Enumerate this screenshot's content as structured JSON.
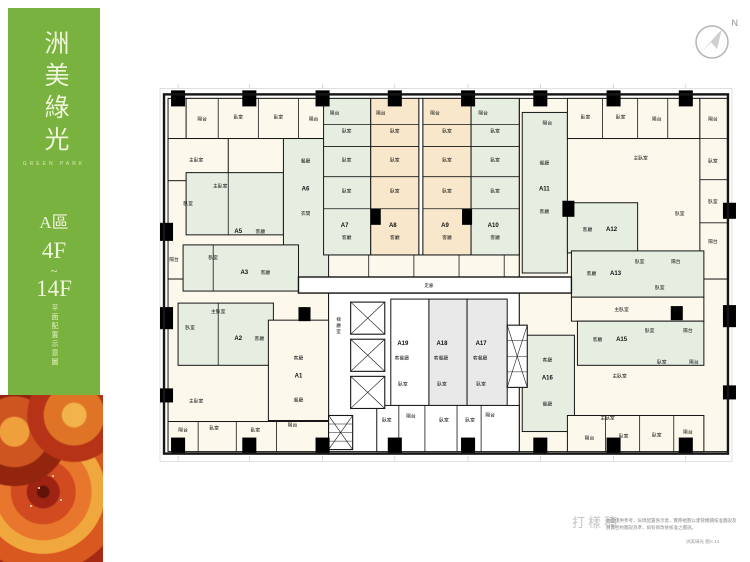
{
  "sidebar": {
    "title": "洲美綠光",
    "subtitle": "GREEN PARK",
    "zone": "A區",
    "floor_from": "4F",
    "tilde": "~",
    "floor_to": "14F",
    "caption": "平面配置示意圖",
    "bg_color": "#79b23f",
    "text_color": "#eef5da"
  },
  "compass": {
    "label": "N"
  },
  "footer": {
    "watermark": "打樣稿",
    "disclaimer1": "本圖僅供參考，傢俱配置係示意，實際規劃以建管機關核准圖說及",
    "disclaimer2": "買賣合約圖說為準，如有修改依核准之圖說。",
    "corner_note": "洲美綠光 圖A-14"
  },
  "plan": {
    "units": [
      "A1",
      "A2",
      "A3",
      "A5",
      "A6",
      "A7",
      "A8",
      "A9",
      "A10",
      "A11",
      "A12",
      "A13",
      "A15",
      "A16",
      "A17",
      "A18",
      "A19"
    ],
    "colors": {
      "wall": "#161616",
      "green": "#e6eee2",
      "peach": "#f8e7ca",
      "cream": "#fcf9ec",
      "gray": "#e9e9e9",
      "white": "#ffffff"
    },
    "rooms": [
      [
        10,
        14,
        160,
        180,
        "cream"
      ],
      [
        360,
        14,
        208,
        180,
        "cream"
      ],
      [
        10,
        194,
        160,
        172,
        "cream"
      ],
      [
        360,
        194,
        208,
        172,
        "cream"
      ],
      [
        170,
        208,
        190,
        158,
        "white"
      ],
      [
        165,
        14,
        195,
        156,
        "cream"
      ],
      [
        165,
        170,
        195,
        22,
        "cream"
      ],
      [
        28,
        14,
        142,
        40,
        "cream"
      ],
      [
        10,
        54,
        60,
        42,
        "cream"
      ],
      [
        28,
        88,
        97,
        62,
        "green"
      ],
      [
        125,
        54,
        45,
        140,
        "green"
      ],
      [
        25,
        160,
        115,
        46,
        "green"
      ],
      [
        20,
        218,
        95,
        62,
        "green"
      ],
      [
        110,
        235,
        60,
        100,
        "cream"
      ],
      [
        165,
        14,
        47,
        156,
        "green"
      ],
      [
        212,
        14,
        48,
        156,
        "peach"
      ],
      [
        260,
        14,
        4,
        156,
        "white"
      ],
      [
        264,
        14,
        48,
        156,
        "peach"
      ],
      [
        312,
        14,
        48,
        156,
        "green"
      ],
      [
        363,
        28,
        45,
        160,
        "green"
      ],
      [
        408,
        14,
        132,
        40,
        "cream"
      ],
      [
        540,
        14,
        28,
        180,
        "cream"
      ],
      [
        408,
        118,
        70,
        50,
        "green"
      ],
      [
        412,
        212,
        132,
        24,
        "cream"
      ],
      [
        412,
        166,
        132,
        46,
        "green"
      ],
      [
        418,
        236,
        126,
        44,
        "green"
      ],
      [
        363,
        250,
        52,
        96,
        "green"
      ],
      [
        232,
        214,
        38,
        106,
        "white"
      ],
      [
        270,
        214,
        38,
        106,
        "gray"
      ],
      [
        308,
        214,
        40,
        106,
        "gray"
      ],
      [
        10,
        336,
        160,
        30,
        "cream"
      ],
      [
        408,
        330,
        136,
        36,
        "cream"
      ],
      [
        218,
        320,
        142,
        46,
        "white"
      ]
    ],
    "lines": [
      [
        165,
        40,
        212,
        40
      ],
      [
        165,
        62,
        212,
        62
      ],
      [
        165,
        92,
        212,
        92
      ],
      [
        165,
        124,
        212,
        124
      ],
      [
        212,
        40,
        260,
        40
      ],
      [
        212,
        62,
        260,
        62
      ],
      [
        212,
        92,
        260,
        92
      ],
      [
        212,
        124,
        260,
        124
      ],
      [
        264,
        40,
        312,
        40
      ],
      [
        264,
        62,
        312,
        62
      ],
      [
        264,
        92,
        312,
        92
      ],
      [
        264,
        124,
        312,
        124
      ],
      [
        312,
        40,
        360,
        40
      ],
      [
        312,
        62,
        360,
        62
      ],
      [
        312,
        92,
        360,
        92
      ],
      [
        312,
        124,
        360,
        124
      ],
      [
        60,
        14,
        60,
        54
      ],
      [
        100,
        14,
        100,
        54
      ],
      [
        140,
        14,
        140,
        54
      ],
      [
        443,
        14,
        443,
        54
      ],
      [
        478,
        14,
        478,
        54
      ],
      [
        508,
        14,
        508,
        54
      ],
      [
        540,
        54,
        568,
        54
      ],
      [
        540,
        95,
        568,
        95
      ],
      [
        540,
        138,
        568,
        138
      ],
      [
        40,
        336,
        40,
        366
      ],
      [
        78,
        336,
        78,
        366
      ],
      [
        118,
        336,
        118,
        366
      ],
      [
        446,
        330,
        446,
        366
      ],
      [
        480,
        330,
        480,
        366
      ],
      [
        514,
        330,
        514,
        366
      ],
      [
        240,
        320,
        240,
        366
      ],
      [
        266,
        320,
        266,
        366
      ],
      [
        298,
        320,
        298,
        366
      ],
      [
        322,
        320,
        322,
        366
      ],
      [
        210,
        170,
        210,
        192
      ],
      [
        255,
        170,
        255,
        192
      ],
      [
        300,
        170,
        300,
        192
      ],
      [
        345,
        170,
        345,
        192
      ],
      [
        70,
        88,
        70,
        150
      ],
      [
        55,
        160,
        55,
        206
      ],
      [
        60,
        218,
        60,
        280
      ]
    ],
    "corridor": {
      "rect": [
        140,
        192,
        272,
        16
      ],
      "label": "走廊"
    },
    "elevators": [
      [
        192,
        217,
        34,
        32
      ],
      [
        192,
        254,
        34,
        32
      ],
      [
        192,
        291,
        34,
        32
      ]
    ],
    "stairs": [
      [
        348,
        240,
        20,
        62
      ],
      [
        170,
        330,
        24,
        34
      ]
    ],
    "columns": [
      [
        13,
        6,
        14,
        16
      ],
      [
        84,
        6,
        14,
        16
      ],
      [
        157,
        6,
        14,
        16
      ],
      [
        229,
        6,
        14,
        16
      ],
      [
        302,
        6,
        14,
        16
      ],
      [
        374,
        6,
        14,
        16
      ],
      [
        447,
        6,
        14,
        16
      ],
      [
        519,
        6,
        14,
        16
      ],
      [
        13,
        352,
        14,
        16
      ],
      [
        84,
        352,
        14,
        16
      ],
      [
        157,
        352,
        14,
        16
      ],
      [
        229,
        352,
        14,
        16
      ],
      [
        302,
        352,
        14,
        16
      ],
      [
        374,
        352,
        14,
        16
      ],
      [
        447,
        352,
        14,
        16
      ],
      [
        519,
        352,
        14,
        16
      ],
      [
        2,
        138,
        13,
        18
      ],
      [
        2,
        222,
        13,
        22
      ],
      [
        2,
        303,
        13,
        14
      ],
      [
        563,
        118,
        13,
        16
      ],
      [
        563,
        220,
        13,
        22
      ],
      [
        563,
        300,
        13,
        14
      ],
      [
        212,
        124,
        10,
        16
      ],
      [
        303,
        124,
        10,
        16
      ],
      [
        403,
        116,
        12,
        16
      ],
      [
        511,
        221,
        12,
        14
      ],
      [
        140,
        222,
        12,
        14
      ]
    ],
    "core_label": {
      "x": 180,
      "y": 236,
      "t": "梯廳室",
      "s": 4.5,
      "v": 1
    },
    "labels": [
      {
        "x": 44,
        "y": 36,
        "t": "陽台"
      },
      {
        "x": 80,
        "y": 34,
        "t": "臥室"
      },
      {
        "x": 120,
        "y": 34,
        "t": "臥室"
      },
      {
        "x": 155,
        "y": 36,
        "t": "陽台"
      },
      {
        "x": 38,
        "y": 77,
        "t": "主臥室"
      },
      {
        "x": 62,
        "y": 103,
        "t": "主臥室"
      },
      {
        "x": 30,
        "y": 120,
        "t": "臥室"
      },
      {
        "x": 80,
        "y": 148,
        "t": "A5",
        "s": 6,
        "b": 1
      },
      {
        "x": 102,
        "y": 148,
        "t": "客廳"
      },
      {
        "x": 147,
        "y": 78,
        "t": "餐廳"
      },
      {
        "x": 147,
        "y": 106,
        "t": "A6",
        "s": 6,
        "b": 1
      },
      {
        "x": 147,
        "y": 130,
        "t": "衣間"
      },
      {
        "x": 86,
        "y": 189,
        "t": "A3",
        "s": 6,
        "b": 1
      },
      {
        "x": 107,
        "y": 189,
        "t": "客廳"
      },
      {
        "x": 55,
        "y": 174,
        "t": "臥室"
      },
      {
        "x": 16,
        "y": 176,
        "t": "陽台"
      },
      {
        "x": 80,
        "y": 255,
        "t": "A2",
        "s": 6,
        "b": 1
      },
      {
        "x": 101,
        "y": 255,
        "t": "客廳"
      },
      {
        "x": 60,
        "y": 228,
        "t": "主臥室"
      },
      {
        "x": 32,
        "y": 244,
        "t": "臥室"
      },
      {
        "x": 140,
        "y": 274,
        "t": "客廳"
      },
      {
        "x": 140,
        "y": 292,
        "t": "A1",
        "s": 6,
        "b": 1
      },
      {
        "x": 140,
        "y": 316,
        "t": "餐廳"
      },
      {
        "x": 38,
        "y": 317,
        "t": "主臥室"
      },
      {
        "x": 25,
        "y": 346,
        "t": "陽台"
      },
      {
        "x": 56,
        "y": 344,
        "t": "臥室"
      },
      {
        "x": 97,
        "y": 346,
        "t": "臥室"
      },
      {
        "x": 134,
        "y": 341,
        "t": "陽台"
      },
      {
        "x": 176,
        "y": 30,
        "t": "陽台"
      },
      {
        "x": 188,
        "y": 48,
        "t": "臥室"
      },
      {
        "x": 188,
        "y": 77,
        "t": "臥室"
      },
      {
        "x": 188,
        "y": 108,
        "t": "臥室"
      },
      {
        "x": 186,
        "y": 142,
        "t": "A7",
        "s": 6,
        "b": 1
      },
      {
        "x": 188,
        "y": 154,
        "t": "客廳"
      },
      {
        "x": 222,
        "y": 30,
        "t": "陽台"
      },
      {
        "x": 236,
        "y": 48,
        "t": "臥室"
      },
      {
        "x": 236,
        "y": 77,
        "t": "臥室"
      },
      {
        "x": 236,
        "y": 108,
        "t": "臥室"
      },
      {
        "x": 234,
        "y": 142,
        "t": "A8",
        "s": 6,
        "b": 1
      },
      {
        "x": 236,
        "y": 154,
        "t": "客廳"
      },
      {
        "x": 276,
        "y": 30,
        "t": "陽台"
      },
      {
        "x": 288,
        "y": 48,
        "t": "臥室"
      },
      {
        "x": 288,
        "y": 77,
        "t": "臥室"
      },
      {
        "x": 288,
        "y": 108,
        "t": "臥室"
      },
      {
        "x": 286,
        "y": 142,
        "t": "A9",
        "s": 6,
        "b": 1
      },
      {
        "x": 288,
        "y": 154,
        "t": "客廳"
      },
      {
        "x": 324,
        "y": 30,
        "t": "陽台"
      },
      {
        "x": 336,
        "y": 48,
        "t": "臥室"
      },
      {
        "x": 336,
        "y": 77,
        "t": "臥室"
      },
      {
        "x": 336,
        "y": 108,
        "t": "臥室"
      },
      {
        "x": 334,
        "y": 142,
        "t": "A10",
        "s": 6,
        "b": 1
      },
      {
        "x": 336,
        "y": 154,
        "t": "客廳"
      },
      {
        "x": 388,
        "y": 40,
        "t": "陽台"
      },
      {
        "x": 385,
        "y": 80,
        "t": "餐廳"
      },
      {
        "x": 385,
        "y": 106,
        "t": "A11",
        "s": 6,
        "b": 1
      },
      {
        "x": 385,
        "y": 128,
        "t": "客廳"
      },
      {
        "x": 426,
        "y": 34,
        "t": "臥室"
      },
      {
        "x": 461,
        "y": 34,
        "t": "臥室"
      },
      {
        "x": 497,
        "y": 36,
        "t": "陽台"
      },
      {
        "x": 481,
        "y": 75,
        "t": "主臥室"
      },
      {
        "x": 520,
        "y": 130,
        "t": "臥室"
      },
      {
        "x": 553,
        "y": 36,
        "t": "陽台"
      },
      {
        "x": 553,
        "y": 78,
        "t": "臥室"
      },
      {
        "x": 553,
        "y": 118,
        "t": "臥室"
      },
      {
        "x": 553,
        "y": 158,
        "t": "陽台"
      },
      {
        "x": 428,
        "y": 146,
        "t": "客廳"
      },
      {
        "x": 452,
        "y": 146,
        "t": "A12",
        "s": 6,
        "b": 1
      },
      {
        "x": 432,
        "y": 190,
        "t": "客廳"
      },
      {
        "x": 456,
        "y": 190,
        "t": "A13",
        "s": 6,
        "b": 1
      },
      {
        "x": 480,
        "y": 178,
        "t": "臥室"
      },
      {
        "x": 516,
        "y": 178,
        "t": "陽台"
      },
      {
        "x": 500,
        "y": 204,
        "t": "臥室"
      },
      {
        "x": 462,
        "y": 226,
        "t": "主臥室"
      },
      {
        "x": 518,
        "y": 226,
        "t": "陽台"
      },
      {
        "x": 438,
        "y": 256,
        "t": "客廳"
      },
      {
        "x": 462,
        "y": 256,
        "t": "A15",
        "s": 6,
        "b": 1
      },
      {
        "x": 490,
        "y": 247,
        "t": "臥室"
      },
      {
        "x": 528,
        "y": 247,
        "t": "陽台"
      },
      {
        "x": 388,
        "y": 276,
        "t": "客廳"
      },
      {
        "x": 388,
        "y": 294,
        "t": "A16",
        "s": 6,
        "b": 1
      },
      {
        "x": 388,
        "y": 320,
        "t": "餐廳"
      },
      {
        "x": 460,
        "y": 292,
        "t": "主臥室"
      },
      {
        "x": 502,
        "y": 278,
        "t": "臥室"
      },
      {
        "x": 534,
        "y": 278,
        "t": "陽台"
      },
      {
        "x": 448,
        "y": 334,
        "t": "主臥室"
      },
      {
        "x": 430,
        "y": 354,
        "t": "陽台"
      },
      {
        "x": 464,
        "y": 352,
        "t": "臥室"
      },
      {
        "x": 497,
        "y": 351,
        "t": "臥室"
      },
      {
        "x": 528,
        "y": 348,
        "t": "陽台"
      },
      {
        "x": 244,
        "y": 260,
        "t": "A19",
        "s": 6,
        "b": 1
      },
      {
        "x": 243,
        "y": 274,
        "t": "客餐廳"
      },
      {
        "x": 244,
        "y": 300,
        "t": "臥室"
      },
      {
        "x": 283,
        "y": 260,
        "t": "A18",
        "s": 6,
        "b": 1
      },
      {
        "x": 282,
        "y": 274,
        "t": "客餐廳"
      },
      {
        "x": 283,
        "y": 300,
        "t": "臥室"
      },
      {
        "x": 322,
        "y": 260,
        "t": "A17",
        "s": 6,
        "b": 1
      },
      {
        "x": 321,
        "y": 274,
        "t": "客餐廳"
      },
      {
        "x": 322,
        "y": 300,
        "t": "臥室"
      },
      {
        "x": 228,
        "y": 336,
        "t": "臥室"
      },
      {
        "x": 252,
        "y": 332,
        "t": "陽台"
      },
      {
        "x": 285,
        "y": 336,
        "t": "臥室"
      },
      {
        "x": 311,
        "y": 336,
        "t": "臥室"
      },
      {
        "x": 331,
        "y": 331,
        "t": "陽台"
      },
      {
        "x": 270,
        "y": 202,
        "t": "走廊",
        "s": 4.5
      }
    ]
  }
}
